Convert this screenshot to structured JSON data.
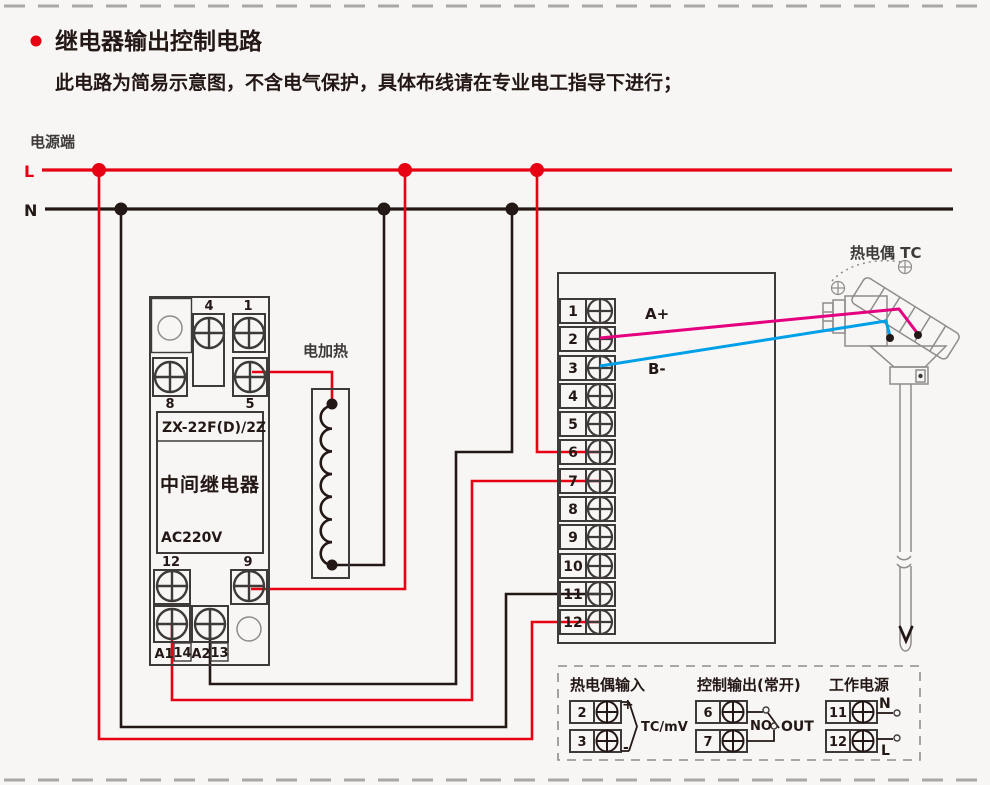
{
  "header": {
    "title": "继电器输出控制电路",
    "subtitle": "此电路为简易示意图，不含电气保护，具体布线请在专业电工指导下进行；"
  },
  "power": {
    "label": "电源端",
    "l": "L",
    "n": "N"
  },
  "relay": {
    "model": "ZX-22F(D)/2Z",
    "name": "中间继电器",
    "voltage": "AC220V",
    "t4": "4",
    "t1": "1",
    "t8": "8",
    "t5": "5",
    "t12": "12",
    "t9": "9",
    "a1": "A1",
    "t14": "14",
    "a2": "A2",
    "t13": "13"
  },
  "heater": {
    "label": "电加热"
  },
  "controller": {
    "terminals": [
      "1",
      "2",
      "3",
      "4",
      "5",
      "6",
      "7",
      "8",
      "9",
      "10",
      "11",
      "12"
    ],
    "wire_a_label": "A+",
    "wire_b_label": "B-"
  },
  "thermocouple": {
    "label": "热电偶 TC"
  },
  "legend": {
    "tc_input": {
      "title": "热电偶输入",
      "t2": "2",
      "t3": "3",
      "plus": "+",
      "minus": "-",
      "signal": "TC/mV"
    },
    "control_output": {
      "title": "控制输出(常开)",
      "t6": "6",
      "t7": "7",
      "no_label": "NO",
      "out_label": "OUT"
    },
    "work_power": {
      "title": "工作电源",
      "t11": "11",
      "t12": "12",
      "n": "N",
      "l": "L"
    }
  },
  "colors": {
    "accent_red": "#e60012",
    "wire_black": "#231815",
    "wire_magenta": "#e4007f",
    "wire_blue": "#00a0e9",
    "component_gray": "#8f8c8b"
  }
}
